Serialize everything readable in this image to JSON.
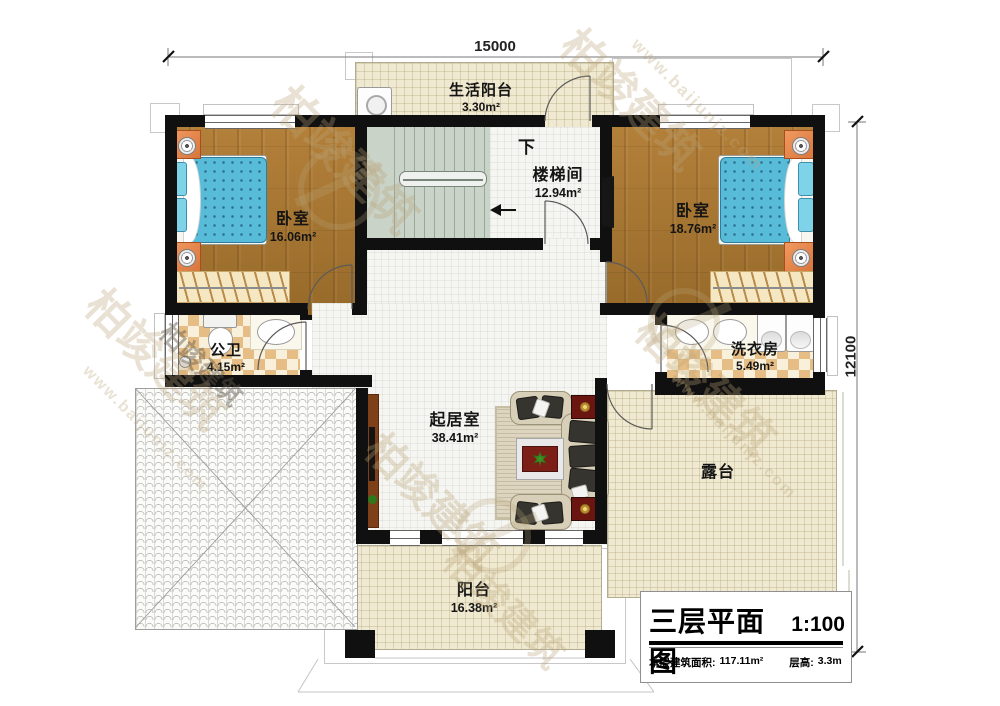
{
  "plan": {
    "dimensions": {
      "top": "15000",
      "right": "12100"
    },
    "stair_direction_note": "下",
    "rooms": {
      "service_balcony": {
        "name": "生活阳台",
        "area": "3.30m²"
      },
      "stairwell": {
        "name": "楼梯间",
        "area": "12.94m²"
      },
      "bedroom_left": {
        "name": "卧室",
        "area": "16.06m²"
      },
      "bedroom_right": {
        "name": "卧室",
        "area": "18.76m²"
      },
      "bathroom": {
        "name": "公卫",
        "area": "4.15m²"
      },
      "laundry": {
        "name": "洗衣房",
        "area": "5.49m²"
      },
      "living_room": {
        "name": "起居室",
        "area": "38.41m²"
      },
      "terrace": {
        "name": "露台"
      },
      "balcony": {
        "name": "阳台",
        "area": "16.38m²"
      }
    }
  },
  "title_block": {
    "title": "三层平面图",
    "scale": "1:100",
    "floor_area_label": "本层建筑面积:",
    "floor_area_value": "117.11m²",
    "floor_height_label": "层高:",
    "floor_height_value": "3.3m"
  },
  "watermark": {
    "brand": "柏竣建筑",
    "url": "www.baijunjz.com"
  },
  "colors": {
    "wall": "#101010",
    "wood_floor": "#a9782f",
    "bed_blue": "#58bcd9",
    "cream_tile": "#f0e9d1",
    "checker_tan": "#e6bd84",
    "stair_green": "#c9d3c8",
    "accent_red": "#6b1511",
    "watermark_tan": "#baa67a"
  }
}
